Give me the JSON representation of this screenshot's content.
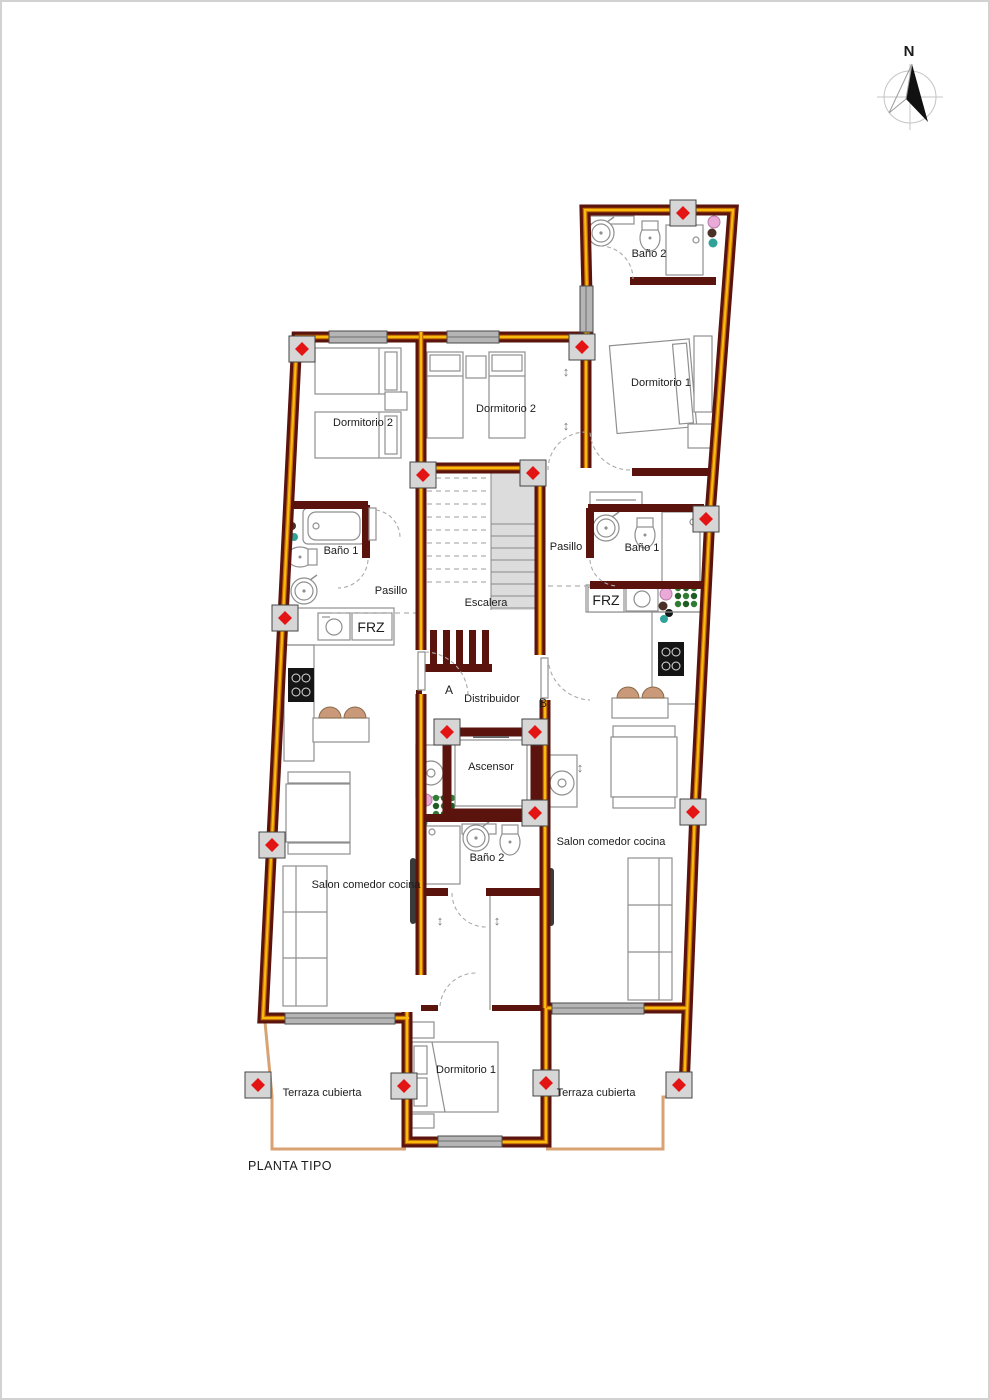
{
  "title": {
    "plan": "PLANTA TIPO"
  },
  "compass": {
    "north": "N"
  },
  "units": {
    "a": "A",
    "b": "B"
  },
  "rooms": {
    "bano2_top": "Baño 2",
    "dormitorio1_top": "Dormitorio 1",
    "dormitorio2_left": "Dormitorio 2",
    "dormitorio2_mid": "Dormitorio 2",
    "bano1_left": "Baño 1",
    "bano1_right": "Baño 1",
    "pasillo_left": "Pasillo",
    "pasillo_right": "Pasillo",
    "escalera": "Escalera",
    "distribuidor": "Distribuidor",
    "ascensor": "Ascensor",
    "bano2_mid": "Baño 2",
    "salon_left": "Salon comedor cocina",
    "salon_right": "Salon comedor cocina",
    "dormitorio1_bottom": "Dormitorio 1",
    "terraza_left": "Terraza cubierta",
    "terraza_right": "Terraza cubierta"
  },
  "appliances": {
    "frz_left": "FRZ",
    "frz_right": "FRZ"
  },
  "colors": {
    "wall_maroon": "#5b130e",
    "stripe_orange": "#c96a00",
    "stripe_yellow": "#f6bb0f",
    "terrace_line": "#d8a272",
    "marker_red": "#e31414",
    "marker_gray": "#d6d6d6",
    "window_gray": "#b5b5b5",
    "stair_gray": "#dcdcdc",
    "plant_green": "#2e7d32",
    "chair_brown": "#c9997a"
  }
}
